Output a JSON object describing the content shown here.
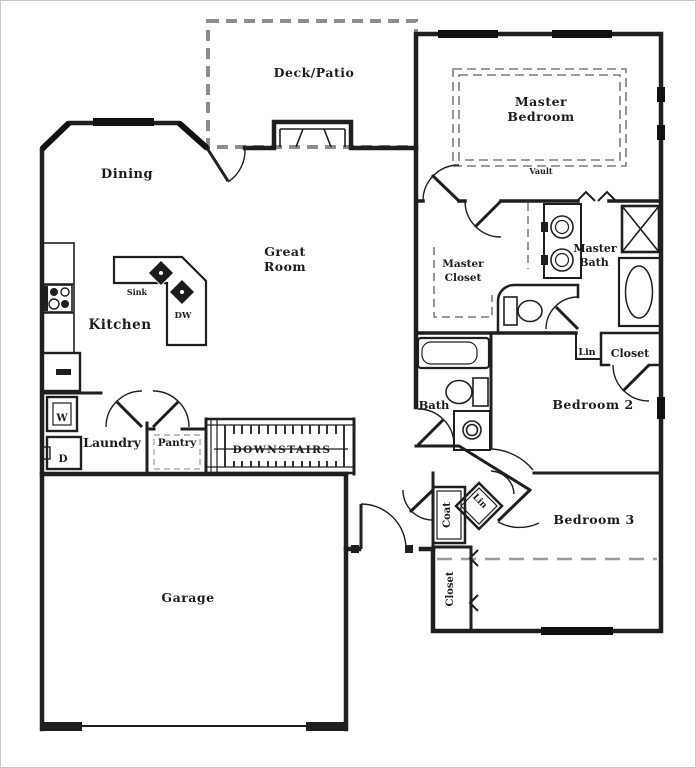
{
  "colors": {
    "wall": "#1f1f1f",
    "dash_gray": "#8d8d8d",
    "background": "#ffffff"
  },
  "plan": {
    "labels": {
      "deck_patio": "Deck/Patio",
      "master_bedroom_1": "Master",
      "master_bedroom_2": "Bedroom",
      "vault": "Vault",
      "dining": "Dining",
      "great_room_1": "Great",
      "great_room_2": "Room",
      "kitchen": "Kitchen",
      "sink": "Sink",
      "dishwasher": "DW",
      "master_closet_1": "Master",
      "master_closet_2": "Closet",
      "master_bath_1": "Master",
      "master_bath_2": "Bath",
      "linen_master": "Lin",
      "closet_master": "Closet",
      "bath": "Bath",
      "bedroom_2": "Bedroom 2",
      "laundry": "Laundry",
      "washer": "W",
      "dryer": "D",
      "pantry": "Pantry",
      "stairs": "DOWNSTAIRS",
      "coat": "Coat",
      "linen_entry": "Lin",
      "bedroom_3": "Bedroom 3",
      "closet_bedroom_3": "Closet",
      "garage": "Garage"
    }
  }
}
